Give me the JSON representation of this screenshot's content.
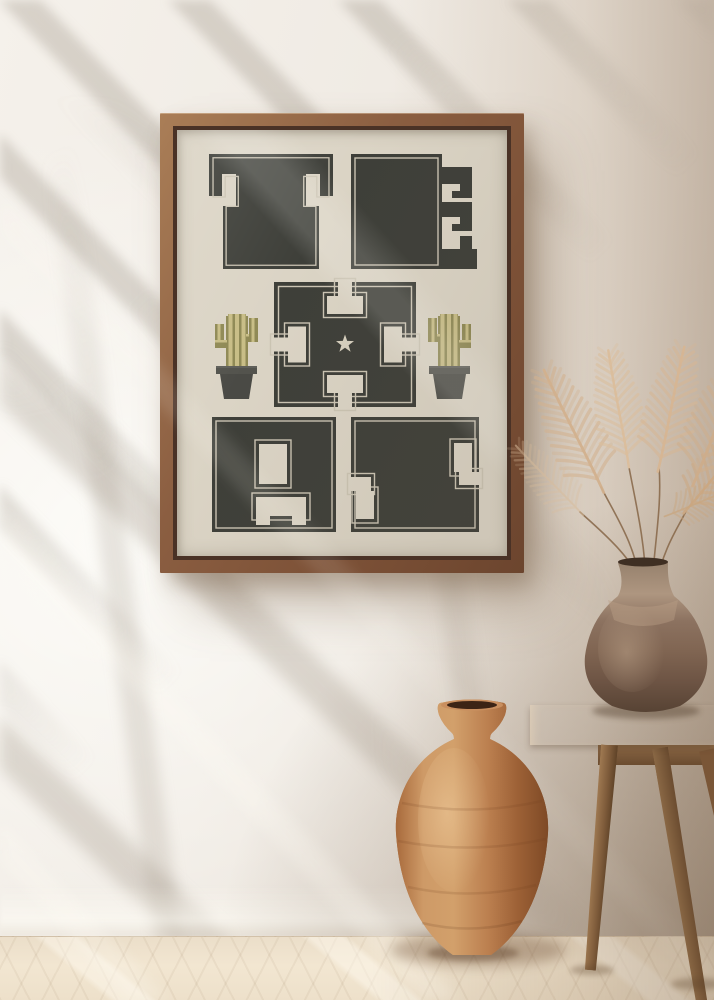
{
  "artwork": {
    "word": "TEXAS",
    "letters": [
      "T",
      "E",
      "X",
      "A",
      "S"
    ],
    "icons": {
      "star": "star-icon",
      "cactus_left": "cactus-icon",
      "cactus_right": "cactus-icon"
    },
    "colors": {
      "letter": "#3E3F39",
      "outline": "#CBC4B3",
      "poster_bg": "#DBD4C5",
      "star": "#D8D1C0",
      "cactus_light": "#C8BD86",
      "cactus_dark": "#8F8955",
      "pot": "#53534D"
    }
  },
  "scene": {
    "wall_color": "#EFEAE3",
    "floor_color": "#EADCC6",
    "frame_wood": "#8B5E41",
    "pampas_color": "#D6B795",
    "floor_vase_color": "#BA7A45",
    "table_vase_color": "#8C7260",
    "table_color": "#97744E",
    "objects": {
      "poster": "texas-poster",
      "frame": "wood-frame",
      "floor_vase": "terracotta-floor-vase",
      "table": "wood-side-table",
      "table_vase": "ceramic-table-vase",
      "plant": "pampas-grass"
    }
  }
}
